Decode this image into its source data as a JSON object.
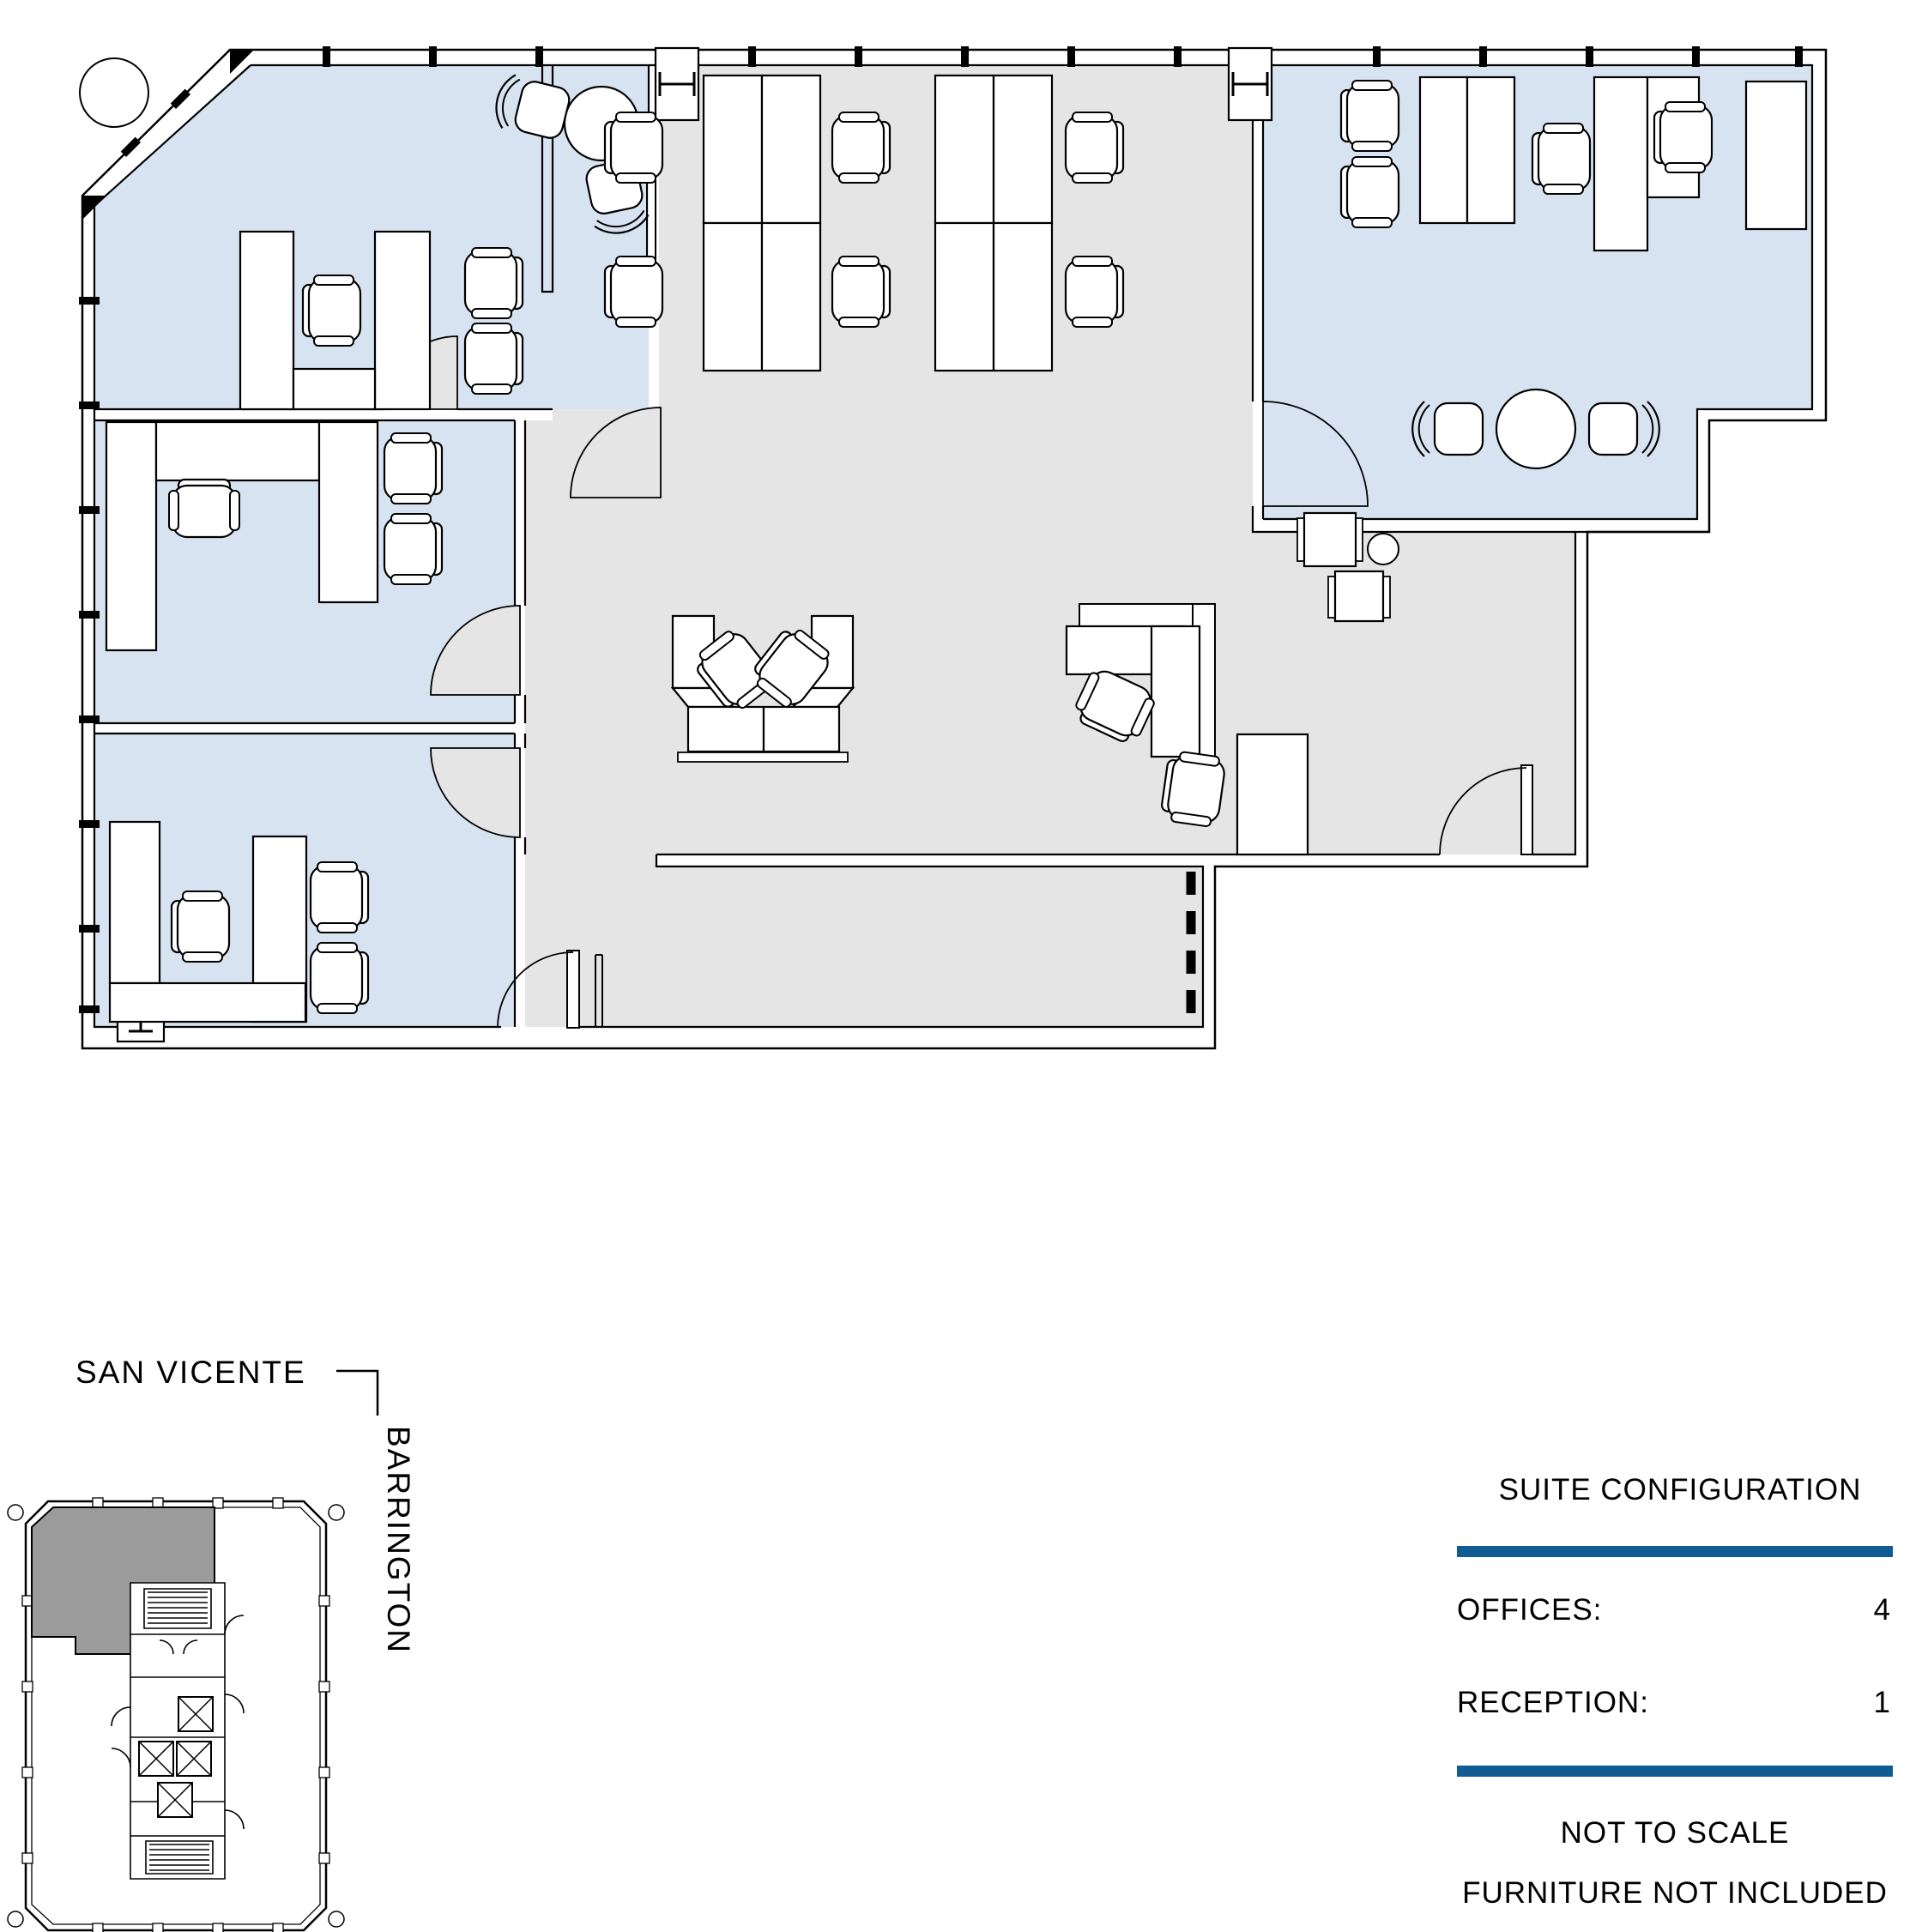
{
  "key_plan": {
    "street_top": "SAN VICENTE",
    "street_side": "BARRINGTON"
  },
  "legend": {
    "title": "SUITE CONFIGURATION",
    "rows": [
      {
        "label": "OFFICES:",
        "value": "4"
      },
      {
        "label": "RECEPTION:",
        "value": "1"
      }
    ],
    "note1": "NOT TO SCALE",
    "note2": "FURNITURE NOT INCLUDED"
  },
  "icons": {
    "h_column": "H-beam-column-symbol",
    "i_column": "I-beam-column-symbol",
    "tree": "tree-circle",
    "door_swing": "door-swing-arc"
  },
  "colors": {
    "office_fill": "#D7E3F0",
    "common_fill": "#E5E5E5",
    "suite_shade": "#9B9B9B",
    "accent": "#0F5B94",
    "wall": "#000000"
  }
}
